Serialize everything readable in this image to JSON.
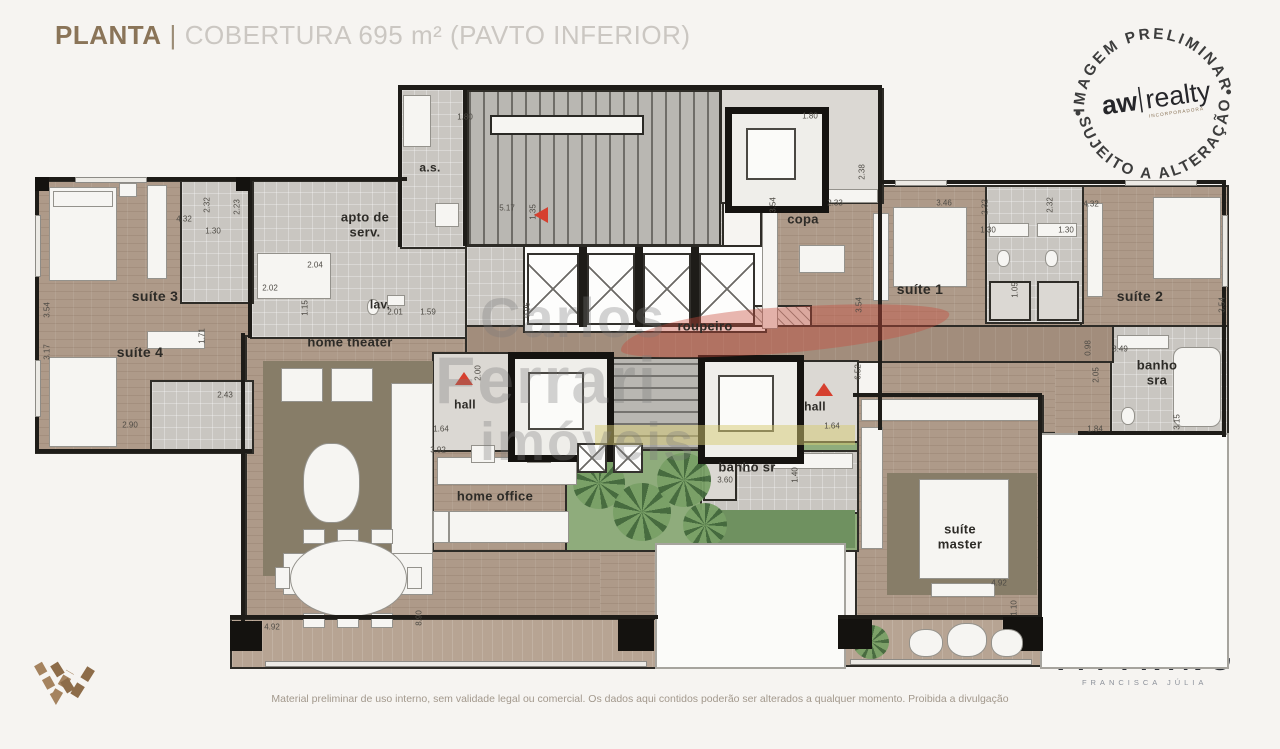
{
  "header": {
    "title_primary": "PLANTA",
    "title_separator": "|",
    "title_secondary": "COBERTURA 695 m² (PAVTO INFERIOR)"
  },
  "stamp": {
    "arc_top": "IMAGEM PRELIMINAR",
    "arc_bottom": "SUJEITO A ALTERAÇÃO",
    "brand_bold": "aw",
    "brand_light": "realty",
    "brand_sub": "INCORPORADORA"
  },
  "watermark": {
    "line1": "Carlos",
    "line2": "Ferrari",
    "line3": "imóveis"
  },
  "rooms": [
    {
      "id": "suite-3",
      "label": "suíte 3",
      "x": 120,
      "y": 212,
      "size": 14
    },
    {
      "id": "suite-4",
      "label": "suíte 4",
      "x": 105,
      "y": 268,
      "size": 14
    },
    {
      "id": "apto-de-serv",
      "label": "apto de\nserv.",
      "x": 330,
      "y": 140,
      "size": 13
    },
    {
      "id": "as",
      "label": "a.s.",
      "x": 395,
      "y": 83,
      "size": 12
    },
    {
      "id": "lav",
      "label": "lav.",
      "x": 345,
      "y": 220,
      "size": 12
    },
    {
      "id": "home-theater",
      "label": "home theater",
      "x": 315,
      "y": 258,
      "size": 13
    },
    {
      "id": "hall-left",
      "label": "hall",
      "x": 430,
      "y": 320,
      "size": 12
    },
    {
      "id": "roupeiro",
      "label": "roupeiro",
      "x": 670,
      "y": 242,
      "size": 13
    },
    {
      "id": "copa",
      "label": "copa",
      "x": 768,
      "y": 135,
      "size": 13
    },
    {
      "id": "suite-1",
      "label": "suíte 1",
      "x": 885,
      "y": 205,
      "size": 14
    },
    {
      "id": "suite-2",
      "label": "suíte 2",
      "x": 1105,
      "y": 212,
      "size": 14
    },
    {
      "id": "banho-sra",
      "label": "banho\nsra",
      "x": 1122,
      "y": 288,
      "size": 13
    },
    {
      "id": "hall-right",
      "label": "hall",
      "x": 780,
      "y": 322,
      "size": 12
    },
    {
      "id": "banho-sr",
      "label": "banho sr",
      "x": 712,
      "y": 383,
      "size": 13
    },
    {
      "id": "home-office",
      "label": "home office",
      "x": 460,
      "y": 412,
      "size": 13
    },
    {
      "id": "suite-master",
      "label": "suíte\nmaster",
      "x": 925,
      "y": 452,
      "size": 13
    }
  ],
  "measurements": [
    {
      "t": "4.32",
      "x": 149,
      "y": 134
    },
    {
      "t": "2.32",
      "x": 172,
      "y": 120,
      "r": 1
    },
    {
      "t": "1.30",
      "x": 178,
      "y": 146
    },
    {
      "t": "2.23",
      "x": 202,
      "y": 122,
      "r": 1
    },
    {
      "t": "3.54",
      "x": 12,
      "y": 225,
      "r": 1
    },
    {
      "t": "3.17",
      "x": 12,
      "y": 267,
      "r": 1
    },
    {
      "t": "1.71",
      "x": 167,
      "y": 251,
      "r": 1
    },
    {
      "t": "2.43",
      "x": 190,
      "y": 310
    },
    {
      "t": "2.90",
      "x": 95,
      "y": 340
    },
    {
      "t": "2.04",
      "x": 280,
      "y": 180
    },
    {
      "t": "2.02",
      "x": 235,
      "y": 203
    },
    {
      "t": "1.15",
      "x": 270,
      "y": 223,
      "r": 1
    },
    {
      "t": "2.01",
      "x": 360,
      "y": 227
    },
    {
      "t": "1.59",
      "x": 393,
      "y": 227
    },
    {
      "t": "1.80",
      "x": 430,
      "y": 32
    },
    {
      "t": "5.17",
      "x": 472,
      "y": 123
    },
    {
      "t": "1.35",
      "x": 498,
      "y": 127,
      "r": 1
    },
    {
      "t": "0.95",
      "x": 492,
      "y": 225,
      "r": 1
    },
    {
      "t": "2.00",
      "x": 443,
      "y": 288,
      "r": 1
    },
    {
      "t": "1.64",
      "x": 406,
      "y": 344
    },
    {
      "t": "3.92",
      "x": 403,
      "y": 365
    },
    {
      "t": "3.54",
      "x": 738,
      "y": 120,
      "r": 1
    },
    {
      "t": "2.33",
      "x": 800,
      "y": 118
    },
    {
      "t": "2.38",
      "x": 827,
      "y": 87,
      "r": 1
    },
    {
      "t": "1.80",
      "x": 775,
      "y": 31
    },
    {
      "t": "3.46",
      "x": 909,
      "y": 118
    },
    {
      "t": "2.32",
      "x": 950,
      "y": 122,
      "r": 1
    },
    {
      "t": "1.30",
      "x": 953,
      "y": 145
    },
    {
      "t": "2.32",
      "x": 1015,
      "y": 120,
      "r": 1
    },
    {
      "t": "1.30",
      "x": 1031,
      "y": 145
    },
    {
      "t": "4.32",
      "x": 1056,
      "y": 119
    },
    {
      "t": "3.54",
      "x": 824,
      "y": 220,
      "r": 1
    },
    {
      "t": "1.05",
      "x": 980,
      "y": 205,
      "r": 1
    },
    {
      "t": "3.54",
      "x": 1187,
      "y": 220,
      "r": 1
    },
    {
      "t": "0.98",
      "x": 1053,
      "y": 263,
      "r": 1
    },
    {
      "t": "3.49",
      "x": 1085,
      "y": 264
    },
    {
      "t": "2.05",
      "x": 1061,
      "y": 290,
      "r": 1
    },
    {
      "t": "1.84",
      "x": 1060,
      "y": 344
    },
    {
      "t": "3.15",
      "x": 1142,
      "y": 337,
      "r": 1
    },
    {
      "t": "6.52",
      "x": 823,
      "y": 287,
      "r": 1
    },
    {
      "t": "1.64",
      "x": 797,
      "y": 341
    },
    {
      "t": "3.60",
      "x": 690,
      "y": 395
    },
    {
      "t": "1.40",
      "x": 760,
      "y": 390,
      "r": 1
    },
    {
      "t": "4.92",
      "x": 964,
      "y": 498
    },
    {
      "t": "1.10",
      "x": 979,
      "y": 523,
      "r": 1
    },
    {
      "t": "4.92",
      "x": 237,
      "y": 542
    },
    {
      "t": "8.90",
      "x": 384,
      "y": 533,
      "r": 1
    }
  ],
  "footer": {
    "disclaimer": "Material preliminar de uso interno, sem validade legal ou comercial. Os dados aqui contidos poderão ser alterados a qualquer momento. Proibida a divulgação",
    "brand_name": "VITTRINO",
    "brand_sub": "FRANCISCA JÚLIA"
  },
  "colors": {
    "accent_red": "#d6402f",
    "title_brown": "#8a7458",
    "title_gray": "#cbc7c2",
    "wood": "#ae9a89",
    "tile": "#c9c6c1",
    "garden": "#8fac7c",
    "logo_brown": "#9c7c58",
    "watermark_red": "rgba(201,74,59,0.40)"
  }
}
